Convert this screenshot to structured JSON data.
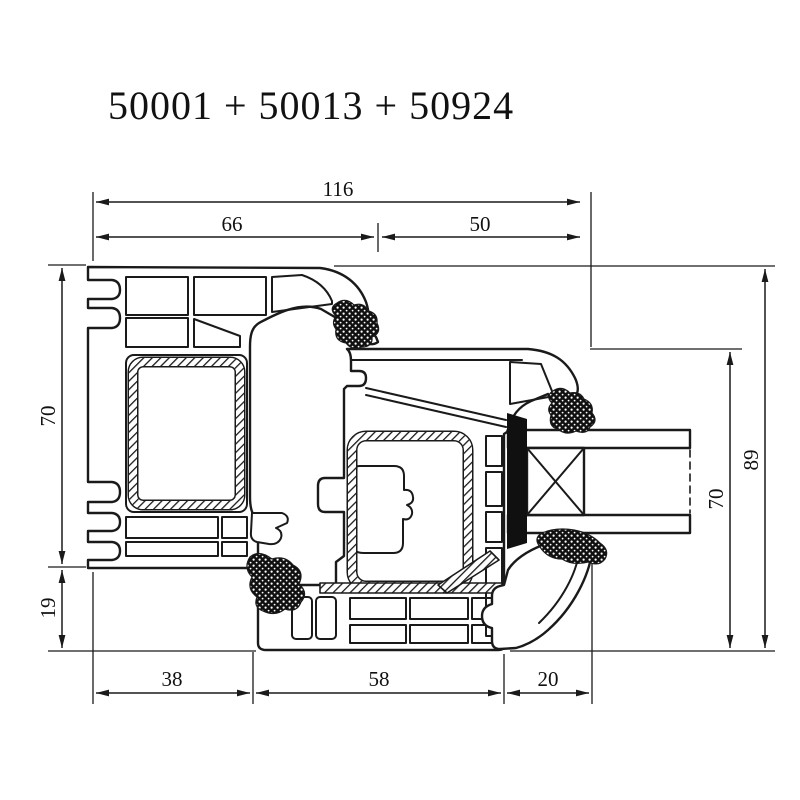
{
  "title": "50001 + 50013 + 50924",
  "parts": [
    "50001",
    "50013",
    "50924"
  ],
  "colors": {
    "ink": "#1a1a1a",
    "background": "#ffffff"
  },
  "dimensions": {
    "top_total": "116",
    "top_left_segment": "66",
    "top_right_segment": "50",
    "left_upper": "70",
    "left_lower": "19",
    "right_outer": "89",
    "right_inner": "70",
    "bottom_left": "38",
    "bottom_middle": "58",
    "bottom_right": "20"
  }
}
